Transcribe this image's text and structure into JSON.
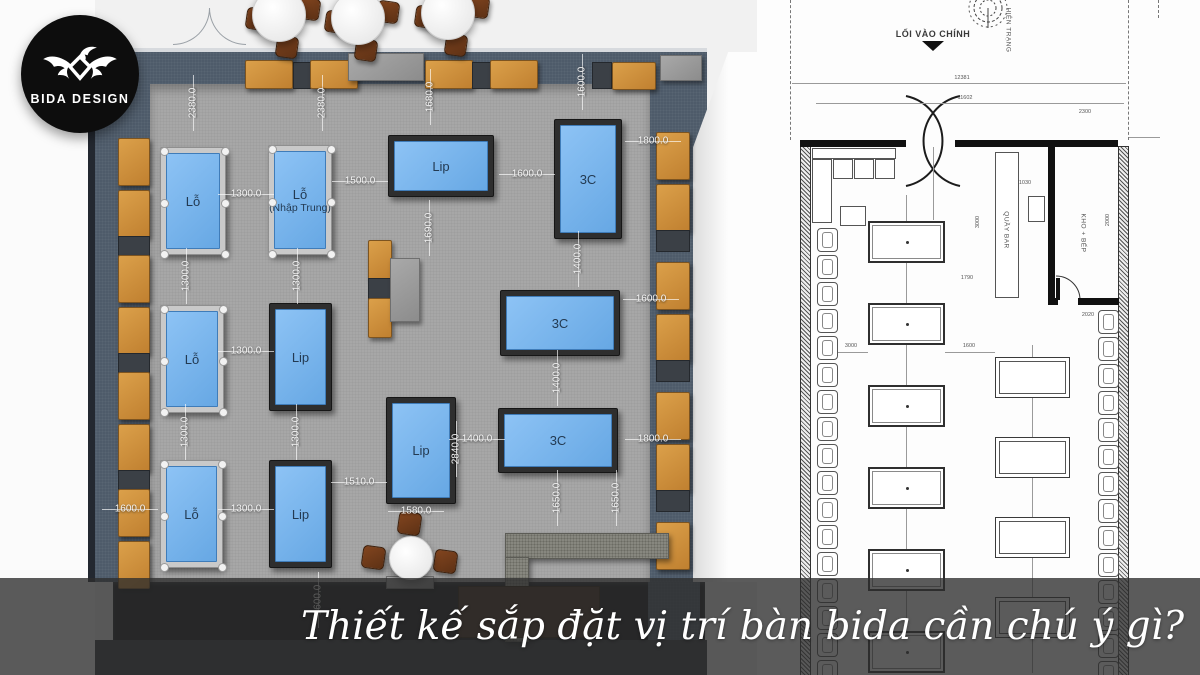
{
  "logo": {
    "brand": "BIDA DESIGN",
    "icon": "eagle-icon"
  },
  "caption": {
    "text": "Thiết kế sắp đặt vị trí bàn bida cần chú ý gì?"
  },
  "colors": {
    "table_felt": "#6db2f2",
    "table_frame_dark": "#2e2e2e",
    "table_frame_light": "#c9c9c9",
    "bench_orange": "#d0913a",
    "wall_slate": "#4e5b6a",
    "floor_gray": "#a7a7a7",
    "overlay": "rgba(45,45,45,0.78)",
    "cad_line": "#555555",
    "logo_bg": "#0d0d0d"
  },
  "left_plan": {
    "tables": [
      {
        "label": "Lỗ",
        "x": 160,
        "y": 147,
        "w": 66,
        "h": 108,
        "kind": "pool"
      },
      {
        "label": "Lỗ",
        "sub": "(Nhập Trung)",
        "x": 268,
        "y": 145,
        "w": 64,
        "h": 110,
        "kind": "pool"
      },
      {
        "label": "Lip",
        "x": 388,
        "y": 135,
        "w": 106,
        "h": 62,
        "kind": "carom"
      },
      {
        "label": "3C",
        "x": 554,
        "y": 119,
        "w": 68,
        "h": 120,
        "kind": "carom"
      },
      {
        "label": "Lỗ",
        "x": 160,
        "y": 305,
        "w": 64,
        "h": 108,
        "kind": "pool"
      },
      {
        "label": "Lip",
        "x": 269,
        "y": 303,
        "w": 63,
        "h": 108,
        "kind": "carom"
      },
      {
        "label": "3C",
        "x": 500,
        "y": 290,
        "w": 120,
        "h": 66,
        "kind": "carom"
      },
      {
        "label": "Lip",
        "x": 386,
        "y": 397,
        "w": 70,
        "h": 107,
        "kind": "carom"
      },
      {
        "label": "3C",
        "x": 498,
        "y": 408,
        "w": 120,
        "h": 65,
        "kind": "carom"
      },
      {
        "label": "Lỗ",
        "x": 160,
        "y": 460,
        "w": 63,
        "h": 108,
        "kind": "pool"
      },
      {
        "label": "Lip",
        "x": 269,
        "y": 460,
        "w": 63,
        "h": 108,
        "kind": "carom"
      }
    ],
    "dimensions": [
      [
        "2380.0",
        193,
        103,
        "v"
      ],
      [
        "2380.0",
        322,
        103,
        "v"
      ],
      [
        "1680.0",
        430,
        97,
        "v"
      ],
      [
        "1600.0",
        582,
        82,
        "v"
      ],
      [
        "1800.0",
        653,
        141,
        "h"
      ],
      [
        "1300.0",
        246,
        194,
        "h"
      ],
      [
        "1500.0",
        360,
        181,
        "h"
      ],
      [
        "1600.0",
        527,
        174,
        "h"
      ],
      [
        "1690.0",
        429,
        228,
        "v"
      ],
      [
        "1400.0",
        578,
        259,
        "v"
      ],
      [
        "1600.0",
        651,
        299,
        "h"
      ],
      [
        "1300.0",
        186,
        276,
        "v"
      ],
      [
        "1300.0",
        297,
        276,
        "v"
      ],
      [
        "1300.0",
        246,
        351,
        "h"
      ],
      [
        "1400.0",
        557,
        378,
        "v"
      ],
      [
        "1300.0",
        185,
        432,
        "v"
      ],
      [
        "1300.0",
        296,
        432,
        "v"
      ],
      [
        "2840.0",
        456,
        449,
        "v"
      ],
      [
        "1400.0",
        477,
        439,
        "h"
      ],
      [
        "1800.0",
        653,
        439,
        "h"
      ],
      [
        "1650.0",
        557,
        498,
        "v"
      ],
      [
        "1650.0",
        616,
        498,
        "v"
      ],
      [
        "1600.0",
        130,
        509,
        "h"
      ],
      [
        "1300.0",
        246,
        509,
        "h"
      ],
      [
        "1510.0",
        359,
        482,
        "h"
      ],
      [
        "1580.0",
        416,
        511,
        "h"
      ],
      [
        "1600.0",
        318,
        600,
        "v"
      ]
    ],
    "furniture": [
      {
        "k": "cush",
        "n": "bench-cushion",
        "x": 245,
        "y": 60,
        "w": 46,
        "h": 27
      },
      {
        "k": "spacer",
        "n": "bench-spacer",
        "x": 293,
        "y": 62,
        "w": 16,
        "h": 25
      },
      {
        "k": "cush",
        "n": "bench-cushion",
        "x": 310,
        "y": 60,
        "w": 46,
        "h": 27
      },
      {
        "k": "gray2",
        "n": "console-cabinet",
        "x": 348,
        "y": 53,
        "w": 74,
        "h": 26
      },
      {
        "k": "cush",
        "n": "bench-cushion",
        "x": 425,
        "y": 60,
        "w": 46,
        "h": 27
      },
      {
        "k": "spacer",
        "n": "bench-spacer",
        "x": 472,
        "y": 62,
        "w": 17,
        "h": 25
      },
      {
        "k": "cush",
        "n": "bench-cushion",
        "x": 490,
        "y": 60,
        "w": 46,
        "h": 27
      },
      {
        "k": "spacer",
        "n": "bench-spacer",
        "x": 592,
        "y": 62,
        "w": 18,
        "h": 25
      },
      {
        "k": "cush",
        "n": "bench-cushion",
        "x": 612,
        "y": 62,
        "w": 42,
        "h": 26
      },
      {
        "k": "gray2",
        "n": "side-cabinet",
        "x": 660,
        "y": 55,
        "w": 40,
        "h": 24
      },
      {
        "k": "cush",
        "n": "bench-cushion",
        "x": 118,
        "y": 138,
        "w": 30,
        "h": 46
      },
      {
        "k": "cush",
        "n": "bench-cushion",
        "x": 118,
        "y": 190,
        "w": 30,
        "h": 46
      },
      {
        "k": "spacer",
        "n": "bench-spacer",
        "x": 118,
        "y": 236,
        "w": 30,
        "h": 19
      },
      {
        "k": "cush",
        "n": "bench-cushion",
        "x": 118,
        "y": 255,
        "w": 30,
        "h": 46
      },
      {
        "k": "cush",
        "n": "bench-cushion",
        "x": 118,
        "y": 307,
        "w": 30,
        "h": 46
      },
      {
        "k": "spacer",
        "n": "bench-spacer",
        "x": 118,
        "y": 353,
        "w": 30,
        "h": 19
      },
      {
        "k": "cush",
        "n": "bench-cushion",
        "x": 118,
        "y": 372,
        "w": 30,
        "h": 46
      },
      {
        "k": "cush",
        "n": "bench-cushion",
        "x": 118,
        "y": 424,
        "w": 30,
        "h": 46
      },
      {
        "k": "spacer",
        "n": "bench-spacer",
        "x": 118,
        "y": 470,
        "w": 30,
        "h": 19
      },
      {
        "k": "cush",
        "n": "bench-cushion",
        "x": 118,
        "y": 489,
        "w": 30,
        "h": 46
      },
      {
        "k": "cush",
        "n": "bench-cushion",
        "x": 118,
        "y": 541,
        "w": 30,
        "h": 46
      },
      {
        "k": "cush",
        "n": "bench-cushion",
        "x": 656,
        "y": 132,
        "w": 32,
        "h": 46
      },
      {
        "k": "cush",
        "n": "bench-cushion",
        "x": 656,
        "y": 184,
        "w": 32,
        "h": 46
      },
      {
        "k": "spacer",
        "n": "bench-spacer",
        "x": 656,
        "y": 230,
        "w": 32,
        "h": 20
      },
      {
        "k": "cush",
        "n": "bench-cushion",
        "x": 656,
        "y": 262,
        "w": 32,
        "h": 46
      },
      {
        "k": "cush",
        "n": "bench-cushion",
        "x": 656,
        "y": 314,
        "w": 32,
        "h": 46
      },
      {
        "k": "spacer",
        "n": "bench-spacer",
        "x": 656,
        "y": 360,
        "w": 32,
        "h": 20
      },
      {
        "k": "cush",
        "n": "bench-cushion",
        "x": 656,
        "y": 392,
        "w": 32,
        "h": 46
      },
      {
        "k": "cush",
        "n": "bench-cushion",
        "x": 656,
        "y": 444,
        "w": 32,
        "h": 46
      },
      {
        "k": "spacer",
        "n": "bench-spacer",
        "x": 656,
        "y": 490,
        "w": 32,
        "h": 20
      },
      {
        "k": "cush",
        "n": "bench-cushion",
        "x": 656,
        "y": 522,
        "w": 32,
        "h": 46
      },
      {
        "k": "cush",
        "n": "bench-cushion",
        "x": 368,
        "y": 240,
        "w": 22,
        "h": 38
      },
      {
        "k": "spacer",
        "n": "bench-spacer",
        "x": 368,
        "y": 278,
        "w": 22,
        "h": 20
      },
      {
        "k": "cush",
        "n": "bench-cushion",
        "x": 368,
        "y": 298,
        "w": 22,
        "h": 38
      },
      {
        "k": "gray2",
        "n": "service-counter",
        "x": 390,
        "y": 258,
        "w": 28,
        "h": 62
      },
      {
        "k": "granite",
        "n": "bar-counter-top",
        "x": 505,
        "y": 533,
        "w": 162,
        "h": 24
      },
      {
        "k": "granite",
        "n": "bar-counter-leg",
        "x": 505,
        "y": 557,
        "w": 22,
        "h": 83
      },
      {
        "k": "cab",
        "n": "bar-cabinet",
        "x": 458,
        "y": 586,
        "w": 140,
        "h": 50
      },
      {
        "k": "gray2",
        "n": "register-desk",
        "x": 386,
        "y": 576,
        "w": 46,
        "h": 11
      }
    ],
    "dining_sets": [
      {
        "cx": 278,
        "cy": 14
      },
      {
        "cx": 357,
        "cy": 17
      },
      {
        "cx": 447,
        "cy": 12
      }
    ],
    "bottom_round_table": {
      "cx": 410,
      "cy": 557,
      "r": 21,
      "stools": [
        [
          398,
          512
        ],
        [
          362,
          546
        ],
        [
          434,
          550
        ]
      ]
    }
  },
  "right_plan": {
    "entrance_label": "LỐI VÀO CHÍNH",
    "site_label": "HIỆN TRẠNG",
    "bar_label": "QUẦY BAR",
    "kitchen_label": "KHO + BẾP",
    "dimensions": [
      [
        "12381",
        962,
        78,
        "h"
      ],
      [
        "11602",
        965,
        98,
        "h"
      ],
      [
        "2300",
        1085,
        112,
        "h"
      ],
      [
        "1030",
        1025,
        183,
        "h"
      ],
      [
        "3000",
        978,
        222,
        "v"
      ],
      [
        "2000",
        1108,
        220,
        "v"
      ],
      [
        "1790",
        967,
        278,
        "h"
      ],
      [
        "3000",
        851,
        346,
        "h"
      ],
      [
        "1600",
        969,
        346,
        "h"
      ],
      [
        "2020",
        1088,
        315,
        "h"
      ]
    ],
    "walls": [
      {
        "k": "cadhatch",
        "n": "wall",
        "x": 800,
        "y": 146,
        "w": 9,
        "h": 529
      },
      {
        "k": "cadhatch",
        "n": "wall",
        "x": 1118,
        "y": 146,
        "w": 9,
        "h": 529
      },
      {
        "k": "cadwall",
        "n": "wall",
        "x": 800,
        "y": 140,
        "w": 106,
        "h": 7
      },
      {
        "k": "cadwall",
        "n": "wall",
        "x": 955,
        "y": 140,
        "w": 163,
        "h": 7
      },
      {
        "k": "cadwall",
        "n": "wall",
        "x": 1048,
        "y": 146,
        "w": 7,
        "h": 158
      },
      {
        "k": "cadwall",
        "n": "wall",
        "x": 1078,
        "y": 298,
        "w": 41,
        "h": 7
      },
      {
        "k": "cadwall",
        "n": "wall",
        "x": 1048,
        "y": 298,
        "w": 10,
        "h": 7
      },
      {
        "k": "cadwall",
        "n": "door-leaf",
        "x": 1056,
        "y": 278,
        "w": 4,
        "h": 22
      },
      {
        "k": "cadthin",
        "n": "bar-counter",
        "x": 995,
        "y": 152,
        "w": 24,
        "h": 146
      },
      {
        "k": "cadthin",
        "n": "sink",
        "x": 1028,
        "y": 196,
        "w": 17,
        "h": 26
      },
      {
        "k": "cadthin",
        "n": "sofa-back",
        "x": 812,
        "y": 148,
        "w": 84,
        "h": 11
      },
      {
        "k": "cadthin",
        "n": "sofa-arm",
        "x": 812,
        "y": 159,
        "w": 20,
        "h": 64
      },
      {
        "k": "cadthin",
        "n": "sofa-cushion",
        "x": 833,
        "y": 159,
        "w": 20,
        "h": 20
      },
      {
        "k": "cadthin",
        "n": "sofa-cushion",
        "x": 854,
        "y": 159,
        "w": 20,
        "h": 20
      },
      {
        "k": "cadthin",
        "n": "sofa-cushion",
        "x": 875,
        "y": 159,
        "w": 20,
        "h": 20
      },
      {
        "k": "cadthin",
        "n": "coffee-table",
        "x": 840,
        "y": 206,
        "w": 26,
        "h": 20
      },
      {
        "k": "cadline",
        "n": "guide-line",
        "x": 906,
        "y": 195,
        "w": 1,
        "h": 478
      },
      {
        "k": "cadline",
        "n": "guide-line",
        "x": 1032,
        "y": 345,
        "w": 1,
        "h": 328
      },
      {
        "k": "cadline",
        "n": "guide-line",
        "x": 933,
        "y": 147,
        "w": 1,
        "h": 73
      },
      {
        "k": "cadline",
        "n": "dim-line",
        "x": 792,
        "y": 83,
        "w": 334,
        "h": 1
      },
      {
        "k": "cadline",
        "n": "dim-line",
        "x": 816,
        "y": 103,
        "w": 308,
        "h": 1
      },
      {
        "k": "cadline",
        "n": "dim-line",
        "x": 838,
        "y": 352,
        "w": 30,
        "h": 1
      },
      {
        "k": "cadline",
        "n": "dim-line",
        "x": 945,
        "y": 352,
        "w": 50,
        "h": 1
      },
      {
        "k": "cadline",
        "n": "dim-line",
        "x": 1128,
        "y": 137,
        "w": 32,
        "h": 1
      },
      {
        "k": "dashv",
        "n": "boundary-dashed",
        "x": 790,
        "y": 0,
        "w": 1,
        "h": 140
      },
      {
        "k": "dashv",
        "n": "boundary-dashed",
        "x": 1128,
        "y": 0,
        "w": 1,
        "h": 140
      },
      {
        "k": "dashv",
        "n": "boundary-dashed",
        "x": 1158,
        "y": 0,
        "w": 1,
        "h": 18
      }
    ],
    "tables_left": {
      "x": 868,
      "w": 77,
      "h": 42,
      "ys": [
        221,
        303,
        385,
        467,
        549,
        631
      ]
    },
    "tables_right": {
      "x": 995,
      "w": 75,
      "h": 41,
      "ys": [
        357,
        437,
        517,
        597
      ]
    },
    "seats_left": {
      "x": 817,
      "w": 21,
      "h": 24,
      "ys": [
        228,
        255,
        282,
        309,
        336,
        363,
        390,
        417,
        444,
        471,
        498,
        525,
        552,
        579,
        606,
        633,
        660
      ]
    },
    "seats_right": {
      "x": 1098,
      "w": 21,
      "h": 24,
      "ys": [
        310,
        337,
        364,
        391,
        418,
        445,
        472,
        499,
        526,
        553,
        580,
        607,
        634,
        661
      ]
    }
  }
}
